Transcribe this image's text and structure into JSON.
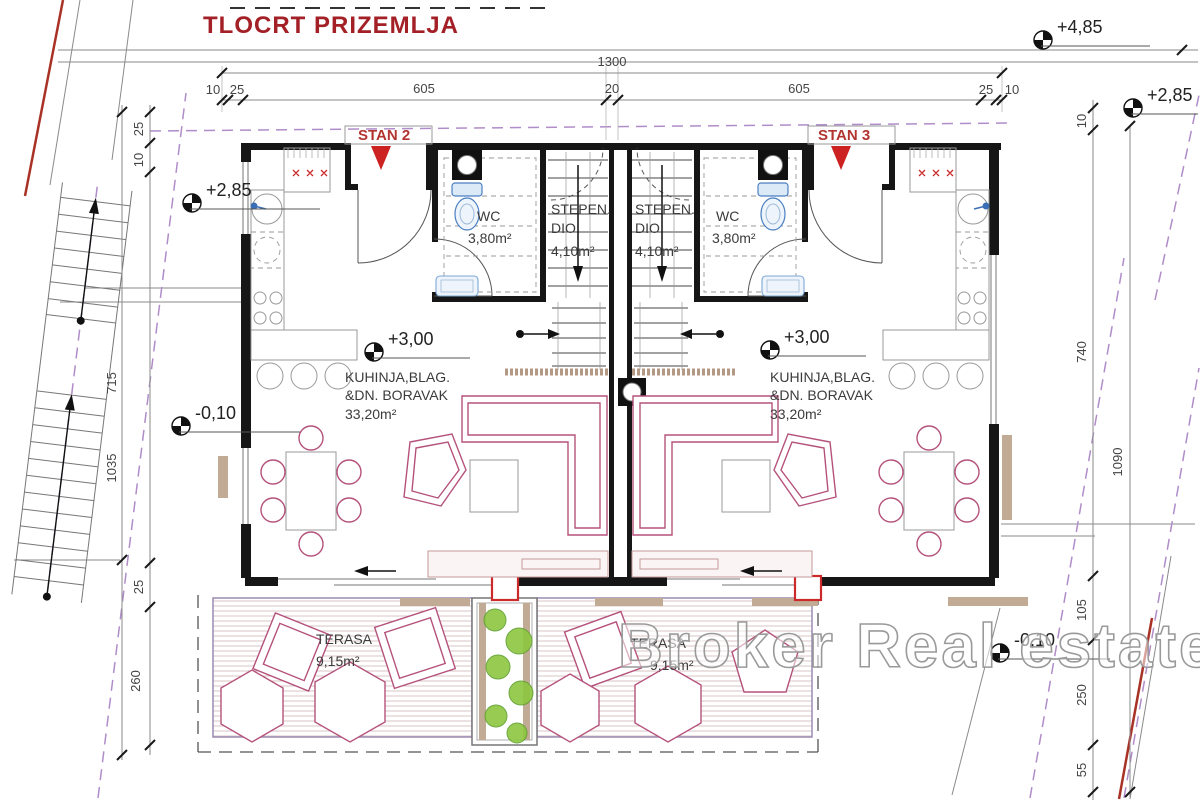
{
  "title": "TLOCRT PRIZEMLJA",
  "watermark": "Broker Real estate",
  "apartments": {
    "left": "STAN 2",
    "right": "STAN 3"
  },
  "rooms": {
    "wc": {
      "name": "WC",
      "area": "3,80m²"
    },
    "stair": {
      "l1": "STEPEN.",
      "l2": "DIO",
      "area": "4,10m²"
    },
    "living": {
      "l1": "KUHINJA,BLAG.",
      "l2": "&DN. BORAVAK",
      "area": "33,20m²"
    },
    "terrace": {
      "name": "TERASA",
      "area": "9,15m²"
    }
  },
  "levels": {
    "roof": "+4,85",
    "upper_right": "+2,85",
    "upper_left": "+2,85",
    "ground_left": "-0,10",
    "floor_left": "+3,00",
    "floor_right": "+3,00",
    "ground_right": "-0,10"
  },
  "dims": {
    "top_total": "1300",
    "top_segments": [
      "10",
      "25",
      "605",
      "20",
      "605",
      "25",
      "10"
    ],
    "left": [
      "25",
      "10",
      "715",
      "1035",
      "25",
      "260"
    ],
    "right": [
      "10",
      "740",
      "1090",
      "105",
      "250",
      "55"
    ]
  },
  "colors": {
    "accent_red": "#a32026",
    "furniture_magenta": "#b5527b",
    "parcel_purple": "#b08cc9",
    "plumbing_blue": "#4a7fc1",
    "plant_green": "#8cc63f",
    "wood_tan": "#c2ab94"
  }
}
